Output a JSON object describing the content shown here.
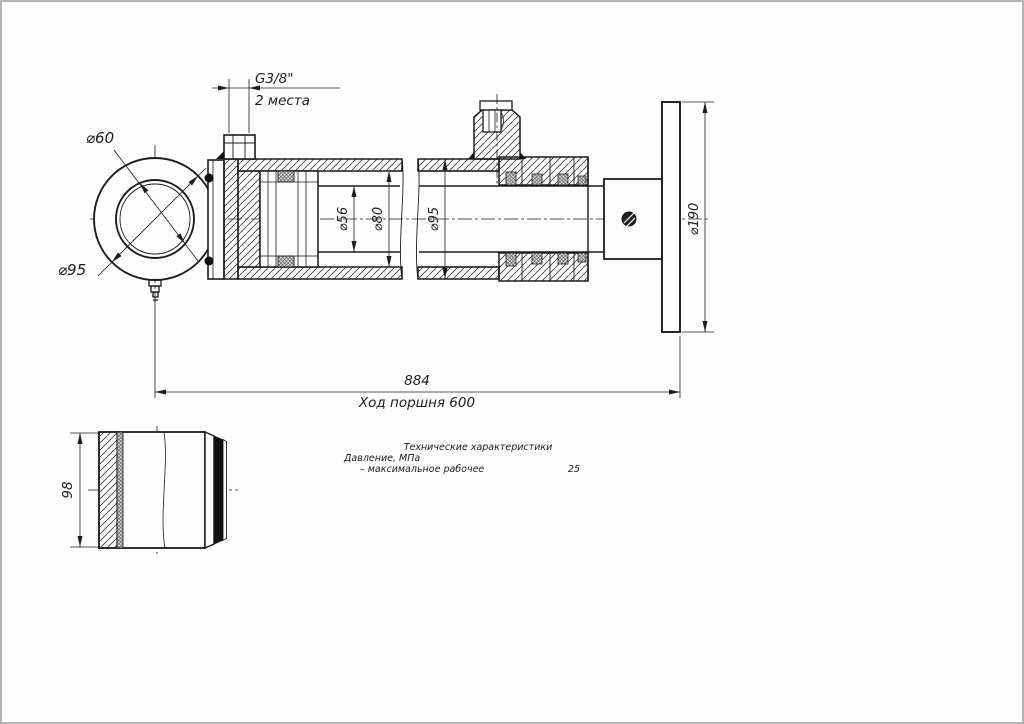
{
  "page": {
    "background": "#fdfdfd",
    "border_color": "#b3b3b3",
    "line_color": "#1c1c1c"
  },
  "main_view": {
    "description": "hydraulic cylinder sectional drawing",
    "dims": {
      "port_thread": "G3/8\"",
      "port_places": "2 места",
      "eye_bore": "⌀60",
      "eye_outer": "⌀95",
      "rod": "⌀56",
      "bore": "⌀80",
      "tube": "⌀95",
      "flange": "⌀190",
      "overall": "884",
      "stroke": "Ход поршня 600"
    }
  },
  "detail_view": {
    "dims": {
      "width": "98"
    }
  },
  "specs": {
    "title": "Технические характеристики",
    "rows": [
      {
        "label": "Давление, МПа",
        "sub": "– максимальное рабочее",
        "value": "25"
      }
    ]
  }
}
